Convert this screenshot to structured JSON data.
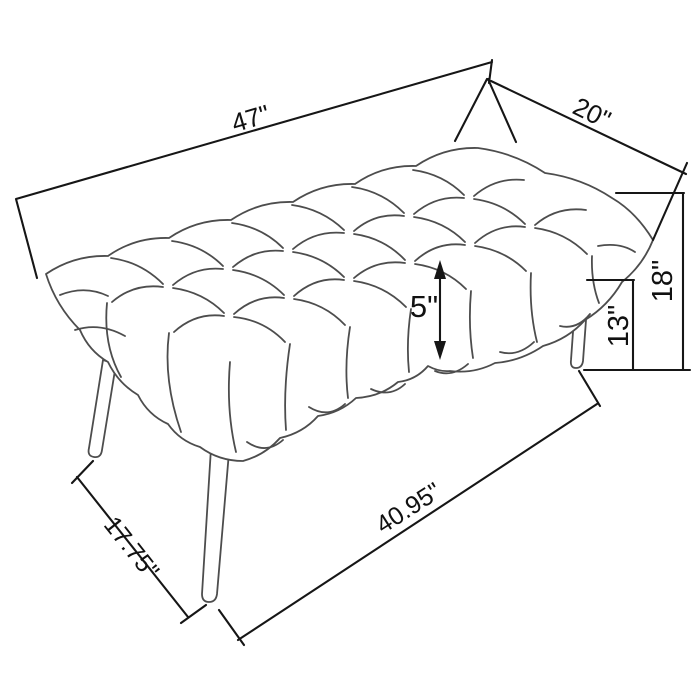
{
  "diagram": {
    "background_color": "#ffffff",
    "artwork_line_color": "#4d4d4d",
    "dimension_line_color": "#161616",
    "text_color": "#111111"
  },
  "dimensions": {
    "overall_length": {
      "label": "47\""
    },
    "overall_depth": {
      "label": "20\""
    },
    "overall_height": {
      "label": "18\""
    },
    "floor_to_seat_bottom": {
      "label": "13\""
    },
    "cushion_thickness": {
      "label": "5\""
    },
    "leg_span_depth": {
      "label": "17.75\""
    },
    "leg_span_length": {
      "label": "40.95\""
    }
  }
}
